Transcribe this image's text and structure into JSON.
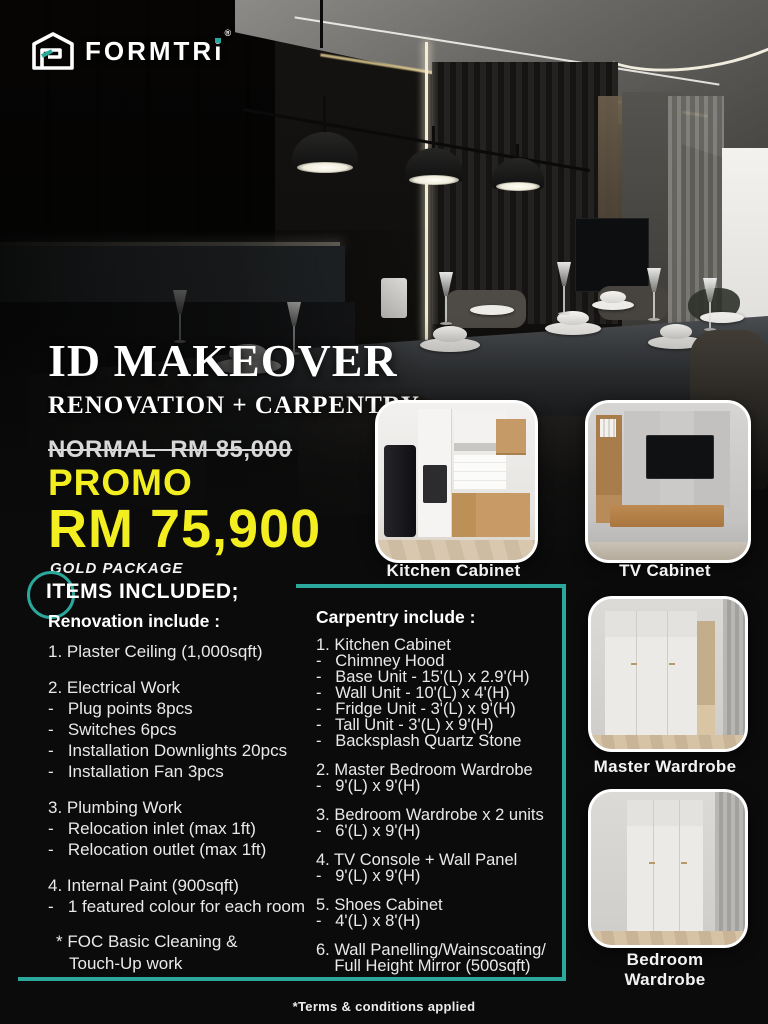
{
  "brand": {
    "logo_text": "FORMTR",
    "logo_i": "i",
    "registered": "®"
  },
  "hero": {
    "title": "ID MAKEOVER",
    "subtitle": "RENOVATION + CARPENTRY",
    "normal_price": "NORMAL  RM 85,000",
    "promo_label": "PROMO",
    "promo_price": "RM 75,900",
    "package_label": "GOLD PACKAGE"
  },
  "items": {
    "heading": "ITEMS INCLUDED;",
    "renovation": {
      "heading": "Renovation include :",
      "lines": [
        "1. Plaster Ceiling (1,000sqft)",
        "",
        "2. Electrical Work",
        "-   Plug points 8pcs",
        "-   Switches 6pcs",
        "-   Installation Downlights 20pcs",
        "-   Installation Fan 3pcs",
        "",
        "3. Plumbing Work",
        "-   Relocation inlet (max 1ft)",
        "-   Relocation outlet (max 1ft)",
        "",
        "4. Internal Paint (900sqft)",
        "-   1 featured colour for each room"
      ]
    },
    "carpentry": {
      "heading": "Carpentry include :",
      "lines": [
        "1. Kitchen Cabinet",
        "-   Chimney Hood",
        "-   Base Unit - 15'(L) x 2.9'(H)",
        "-   Wall Unit - 10'(L) x 4'(H)",
        "-   Fridge Unit - 3'(L) x 9'(H)",
        "-   Tall Unit - 3'(L) x 9'(H)",
        "-   Backsplash Quartz Stone",
        "",
        "2. Master Bedroom Wardrobe",
        "-   9'(L) x 9'(H)",
        "",
        "3. Bedroom Wardrobe x 2 units",
        "-   6'(L) x 9'(H)",
        "",
        "4. TV Console + Wall Panel",
        "-   9'(L) x 9'(H)",
        "",
        "5. Shoes Cabinet",
        "-   4'(L) x 8'(H)",
        "",
        "6. Wall Panelling/Wainscoating/",
        "    Full Height Mirror (500sqft)"
      ]
    },
    "footnote": {
      "line1": "* FOC Basic Cleaning &",
      "line2": "Touch-Up work"
    }
  },
  "gallery": [
    {
      "label": "Kitchen Cabinet"
    },
    {
      "label": "TV Cabinet"
    },
    {
      "label": "Master Wardrobe"
    },
    {
      "label": "Bedroom Wardrobe"
    }
  ],
  "footer": {
    "terms": "*Terms & conditions applied"
  },
  "colors": {
    "accent_teal": "#2aa89c",
    "promo_yellow": "#f2ee1f"
  }
}
